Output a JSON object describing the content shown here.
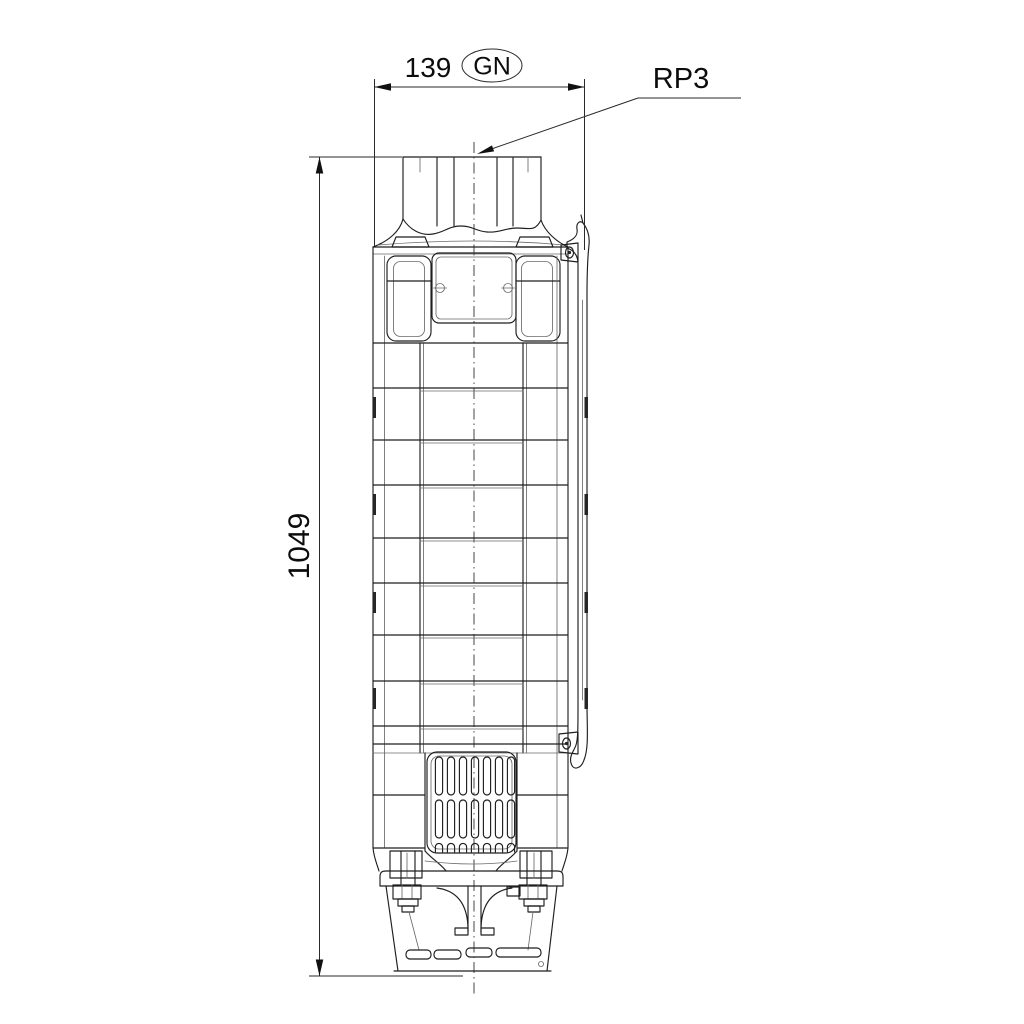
{
  "page": {
    "background": "#ffffff"
  },
  "drawing": {
    "kind": "pump-outline-dimension-drawing",
    "line_color": "#1f1f1f",
    "text_color": "#0c0c0c",
    "dim_width": "139",
    "dim_width_badge": "GN",
    "dim_height": "1049",
    "connection_callout": "RP3"
  }
}
